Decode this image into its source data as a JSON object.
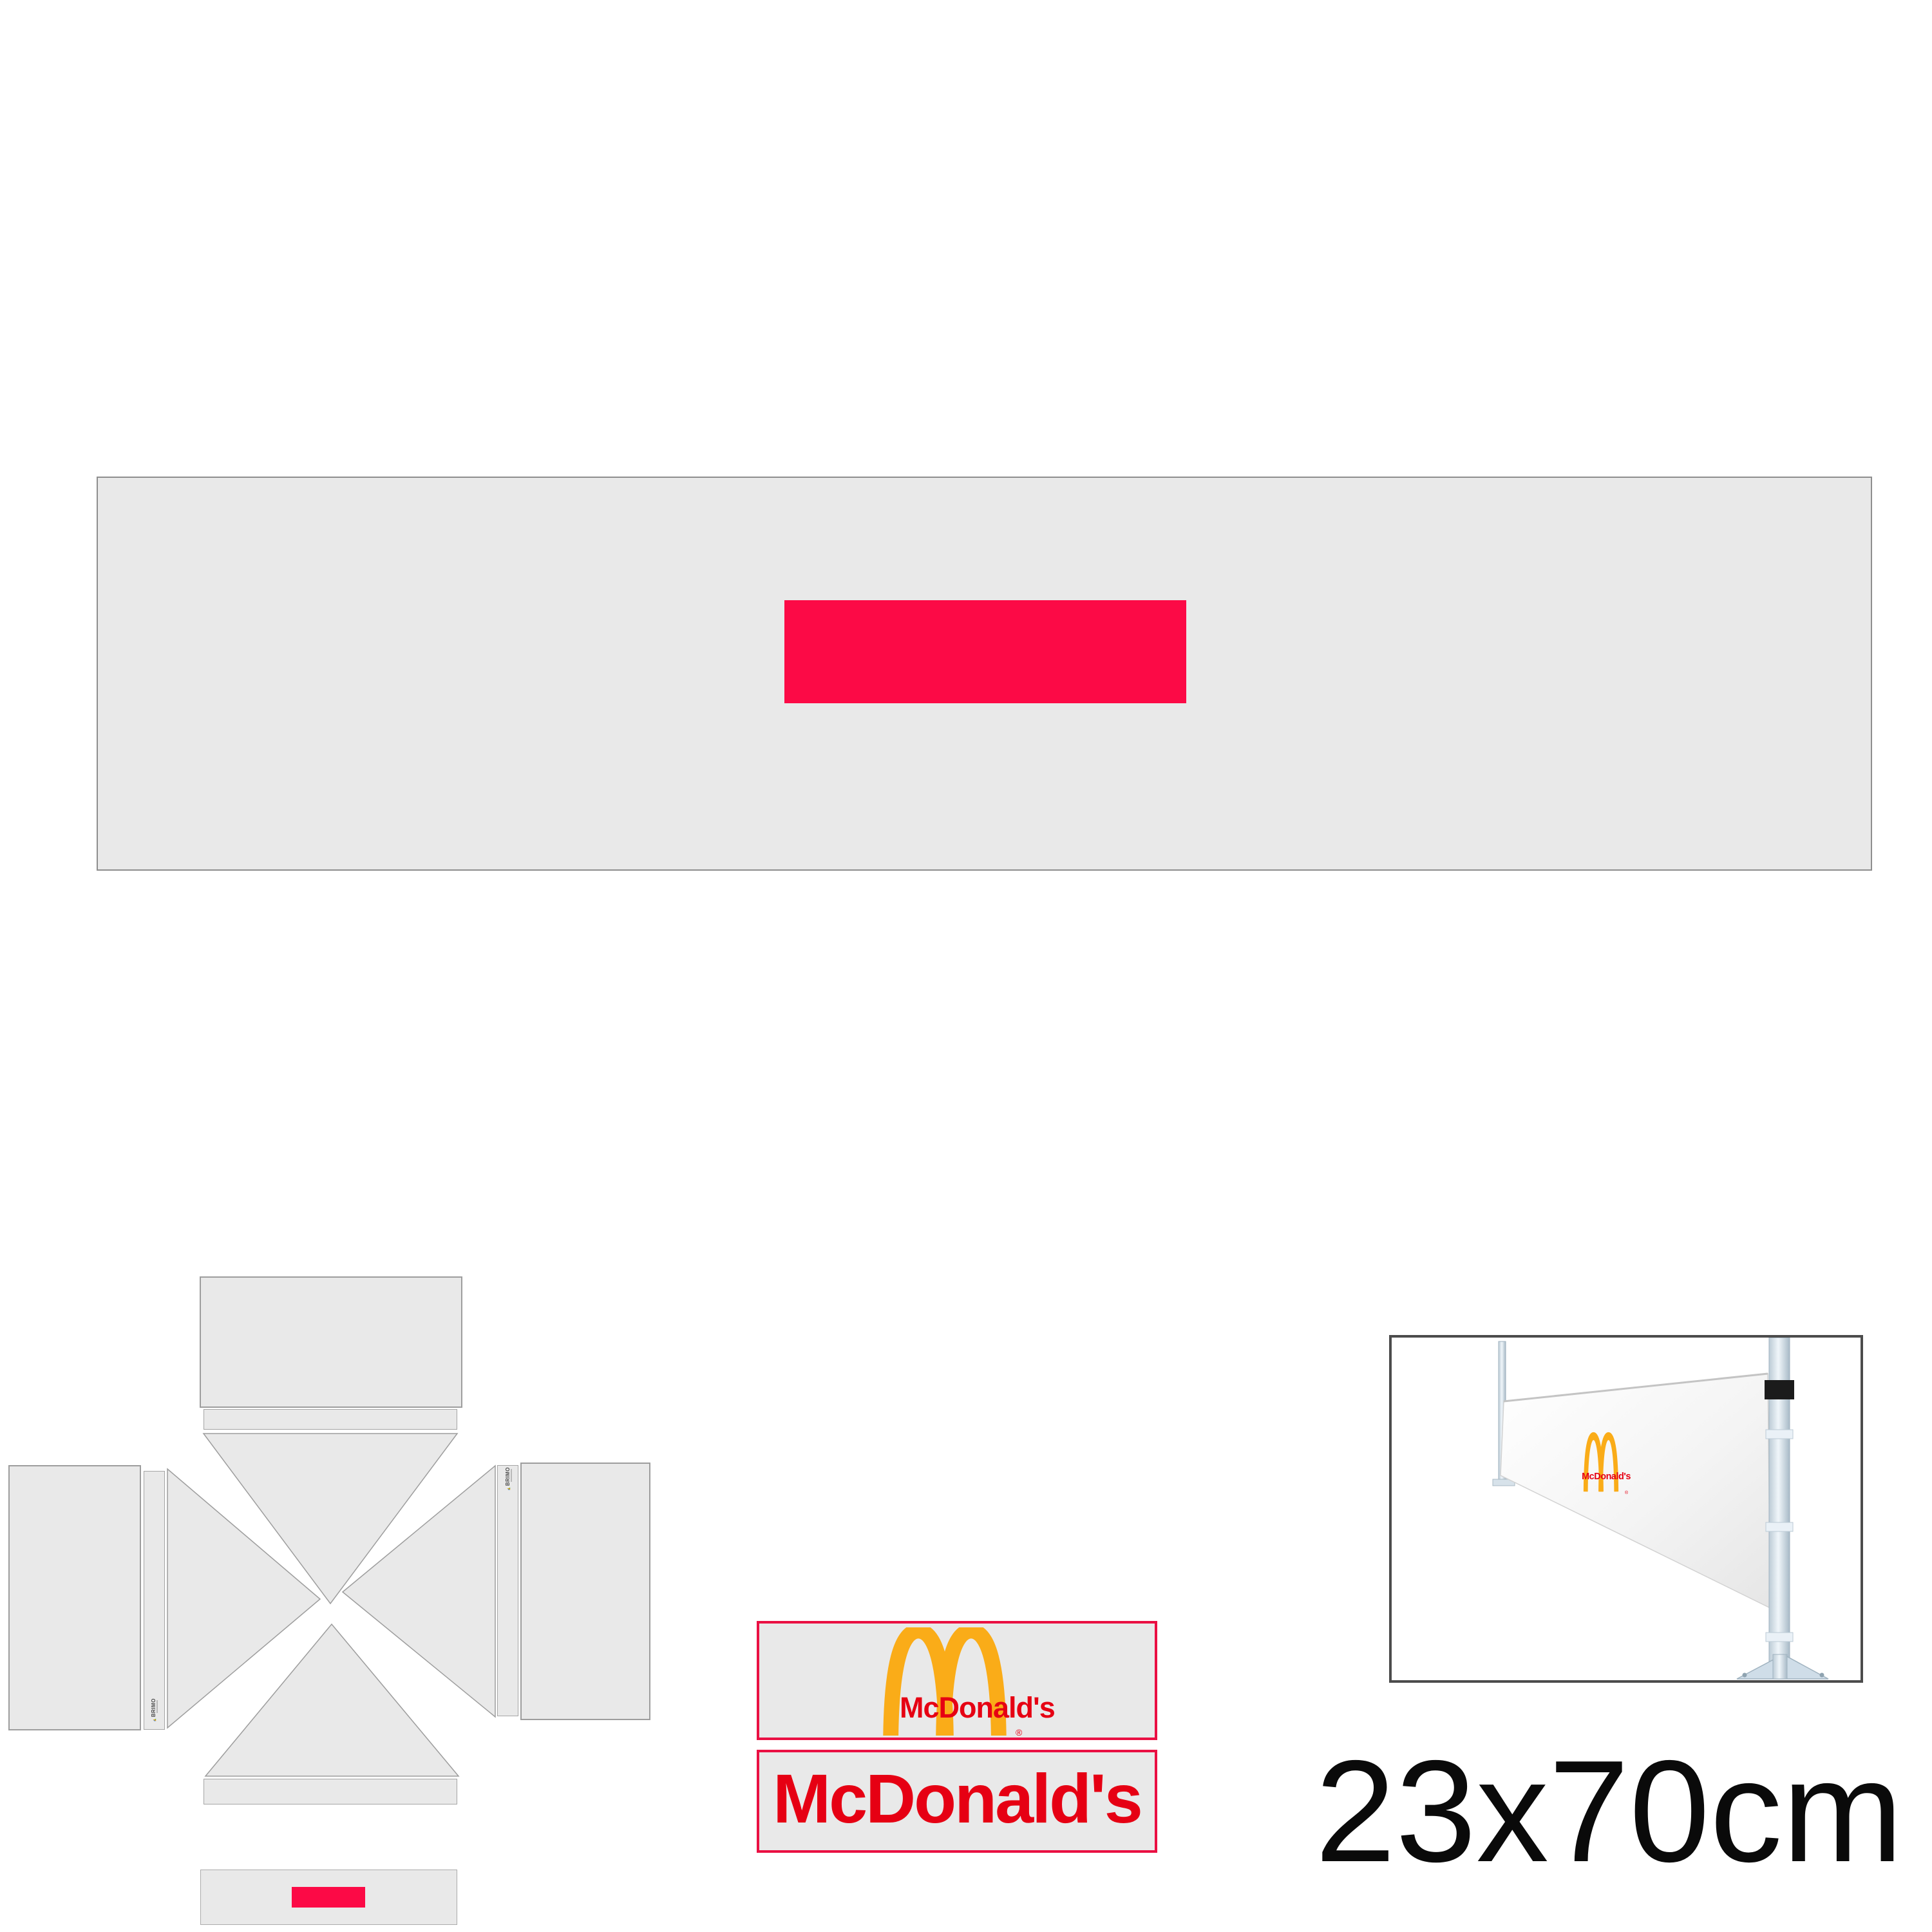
{
  "page": {
    "background": "#ffffff",
    "dimension_label": "23x70cm"
  },
  "product_banner": {
    "fabric_color": "#e9e9e9",
    "outline_color": "#8e8e8e",
    "print_area_color": "#fc0a46"
  },
  "tent_diagram": {
    "panel_color": "#e9e9e9",
    "outline_color": "#9d9d9d",
    "mini_print_color": "#fc0a46",
    "brand_logo": {
      "text": "BRIMO",
      "icon_colors": [
        "#2f7fd0",
        "#f59a00",
        "#58b947"
      ]
    }
  },
  "branding_banners": {
    "background": "#e9e9e9",
    "border_color": "#ea1043",
    "arches_banner": {
      "wordmark": "McDonald's",
      "registered_mark": "®",
      "arch_color": "#FAAC18",
      "wordmark_color": "#e60013"
    },
    "wordmark_banner": {
      "wordmark": "McDonald's",
      "wordmark_color": "#e60013"
    }
  },
  "photo": {
    "frame_color": "#4c4c4c",
    "pole_color": "#cfdde8",
    "strap_color": "#1b1b1b",
    "fabric_color": "#f7f7f7",
    "logo": {
      "wordmark": "McDonald's",
      "registered_mark": "®",
      "arch_color": "#FAAC18",
      "wordmark_color": "#e60013"
    }
  }
}
